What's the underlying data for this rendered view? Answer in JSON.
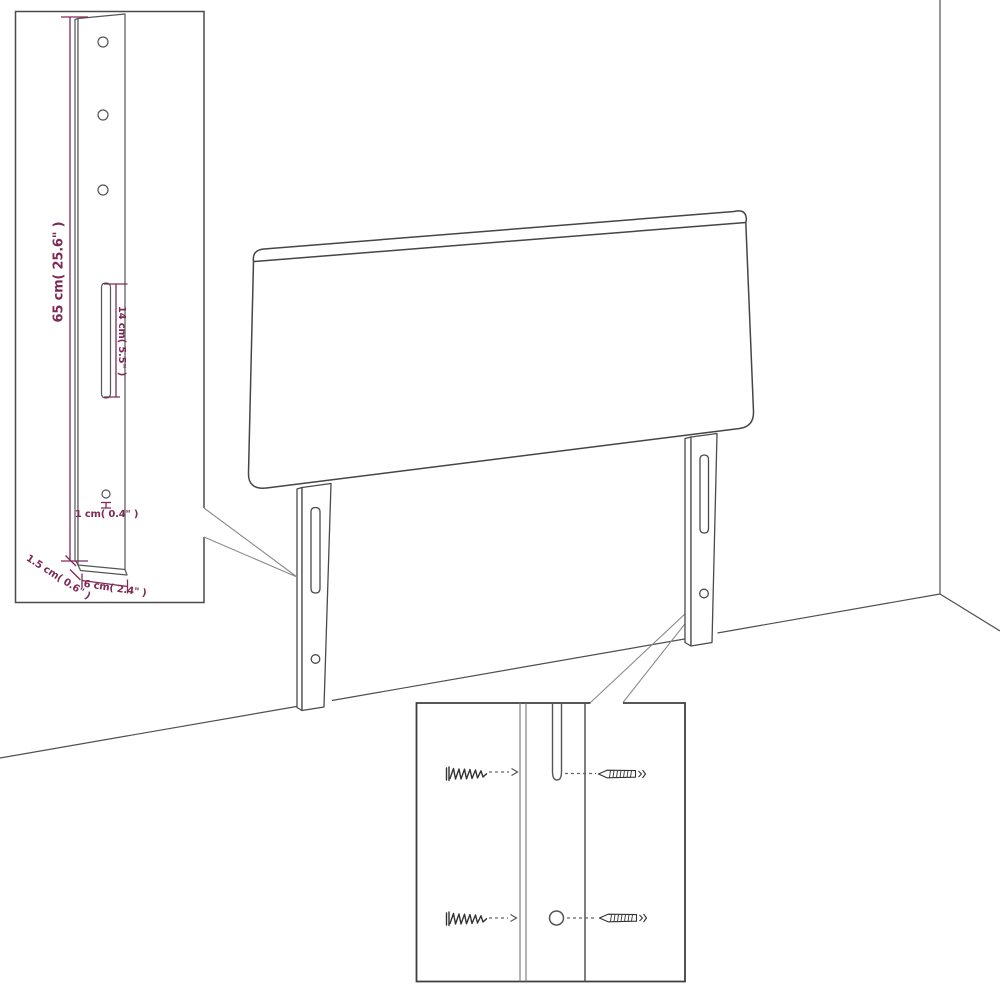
{
  "diagram": {
    "kind": "furniture-assembly-diagram",
    "subject": "bed headboard with two mounting legs, wall corner perspective, two detail insets",
    "colors": {
      "accent": "#7d2b56",
      "line": "#4a4a4a",
      "background": "#ffffff"
    },
    "labels": {
      "leg_height": "65 cm( 25.6\" )",
      "slot_length": "14 cm( 5.5\" )",
      "hole_diameter": "1 cm( 0.4\" )",
      "leg_thickness": "1.5 cm( 0.6\" )",
      "leg_width": "6 cm( 2.4\" )"
    }
  }
}
